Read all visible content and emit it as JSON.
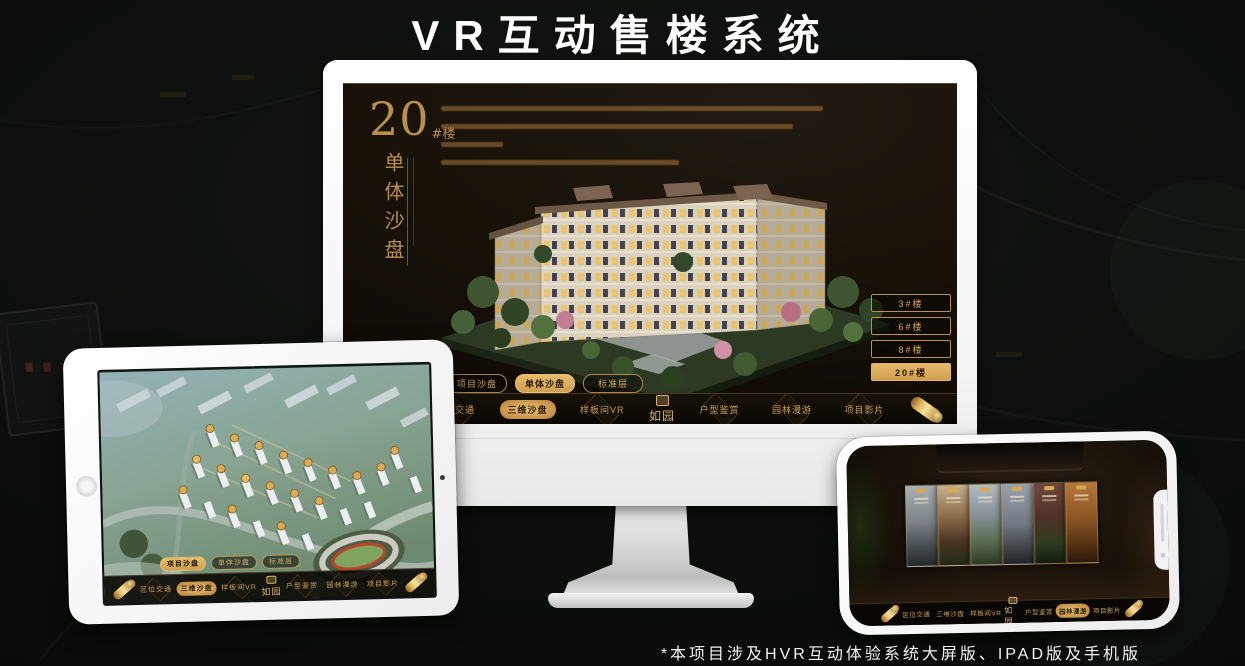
{
  "header": {
    "title": "VR互动售楼系统"
  },
  "footer": {
    "note": "*本项目涉及HVR互动体验系统大屏版、IPAD版及手机版"
  },
  "brand": {
    "logo": "如园"
  },
  "colors": {
    "accent_gold": "#d2a55c",
    "screen_background": "#171108",
    "title_white": "#ffffff"
  },
  "monitor_app": {
    "heading": {
      "number": "20",
      "unit": "#楼",
      "subtitle": "单体沙盘"
    },
    "building_selector": {
      "items": [
        {
          "label": "3#楼",
          "active": false
        },
        {
          "label": "6#楼",
          "active": false
        },
        {
          "label": "8#楼",
          "active": false
        },
        {
          "label": "20#楼",
          "active": true
        }
      ]
    },
    "floor_tabs": {
      "items": [
        {
          "label": "项目沙盘",
          "active": false
        },
        {
          "label": "单体沙盘",
          "active": true
        },
        {
          "label": "标准层",
          "active": false
        }
      ]
    },
    "nav": {
      "items": [
        {
          "label": "区位交通",
          "active": false
        },
        {
          "label": "三维沙盘",
          "active": true
        },
        {
          "label": "样板间VR",
          "active": false
        },
        {
          "label": "户型鉴赏",
          "active": false
        },
        {
          "label": "园林漫游",
          "active": false
        },
        {
          "label": "项目影片",
          "active": false
        }
      ]
    }
  },
  "ipad_app": {
    "floor_tabs": {
      "items": [
        {
          "label": "项目沙盘",
          "active": true
        },
        {
          "label": "单体沙盘",
          "active": false
        },
        {
          "label": "标准层",
          "active": false
        }
      ]
    },
    "nav": {
      "items": [
        {
          "label": "区位交通",
          "active": false
        },
        {
          "label": "三维沙盘",
          "active": true
        },
        {
          "label": "样板间VR",
          "active": false
        },
        {
          "label": "户型鉴赏",
          "active": false
        },
        {
          "label": "园林漫游",
          "active": false
        },
        {
          "label": "项目影片",
          "active": false
        }
      ]
    }
  },
  "phone_app": {
    "nav": {
      "items": [
        {
          "label": "区位交通",
          "active": false
        },
        {
          "label": "三维沙盘",
          "active": false
        },
        {
          "label": "样板间VR",
          "active": false
        },
        {
          "label": "户型鉴赏",
          "active": false
        },
        {
          "label": "园林漫游",
          "active": true
        },
        {
          "label": "项目影片",
          "active": false
        }
      ]
    }
  }
}
